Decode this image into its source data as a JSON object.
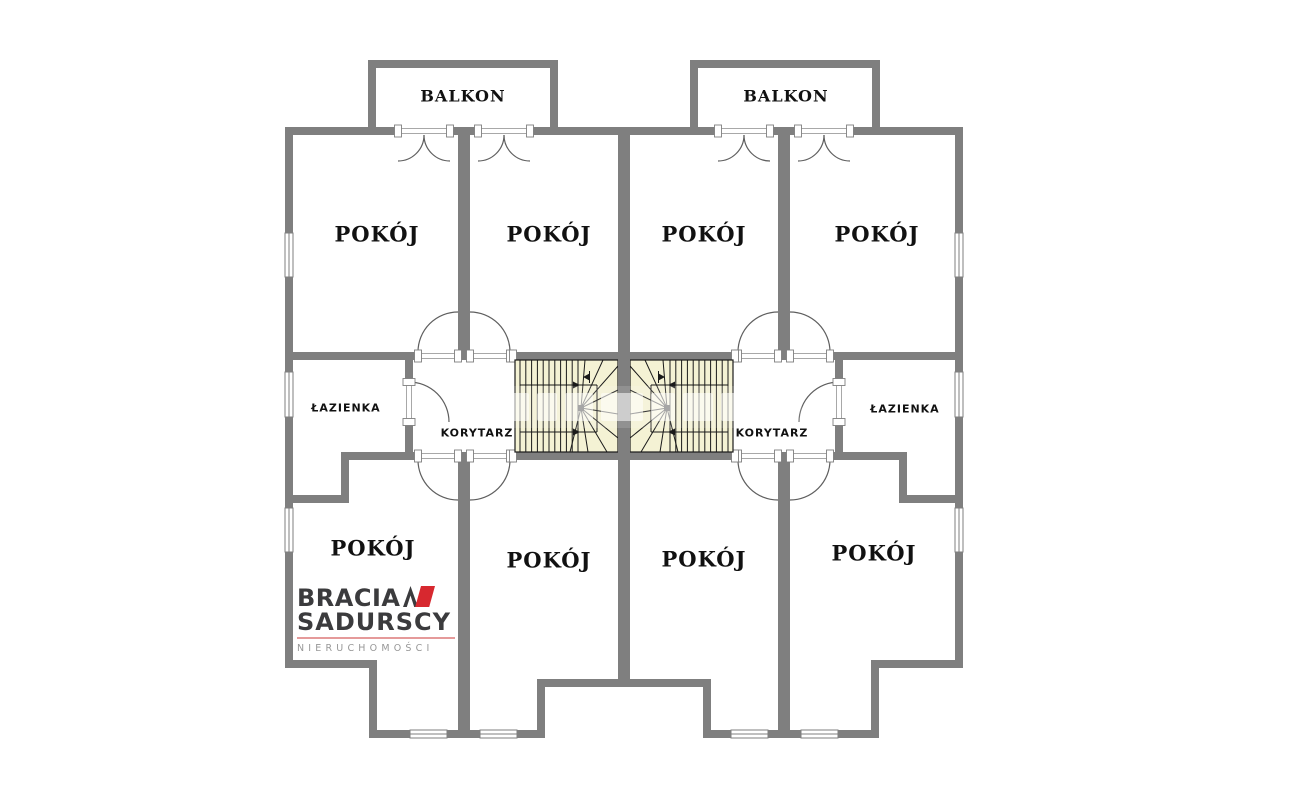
{
  "balconies": [
    {
      "label": "BALKON"
    },
    {
      "label": "BALKON"
    }
  ],
  "rooms_top": [
    {
      "label": "POKÓJ"
    },
    {
      "label": "POKÓJ"
    },
    {
      "label": "POKÓJ"
    },
    {
      "label": "POKÓJ"
    }
  ],
  "rooms_bottom": [
    {
      "label": "POKÓJ"
    },
    {
      "label": "POKÓJ"
    },
    {
      "label": "POKÓJ"
    },
    {
      "label": "POKÓJ"
    }
  ],
  "bathrooms": [
    {
      "label": "ŁAZIENKA"
    },
    {
      "label": "ŁAZIENKA"
    }
  ],
  "corridors": [
    {
      "label": "KORYTARZ"
    },
    {
      "label": "KORYTARZ"
    }
  ],
  "logo": {
    "line1": "BRACIA",
    "line2": "SADURSCY",
    "subtitle": "NIERUCHOMOŚCI"
  },
  "colors": {
    "wall": "#7f7f7f",
    "stair_fill": "#f4f2d4",
    "stair_line": "#1a1a1a",
    "label": "#111111",
    "logo_dark": "#3b3b3d",
    "logo_red": "#d7282f",
    "logo_rule": "#e59a9a",
    "logo_gray": "#979797"
  }
}
